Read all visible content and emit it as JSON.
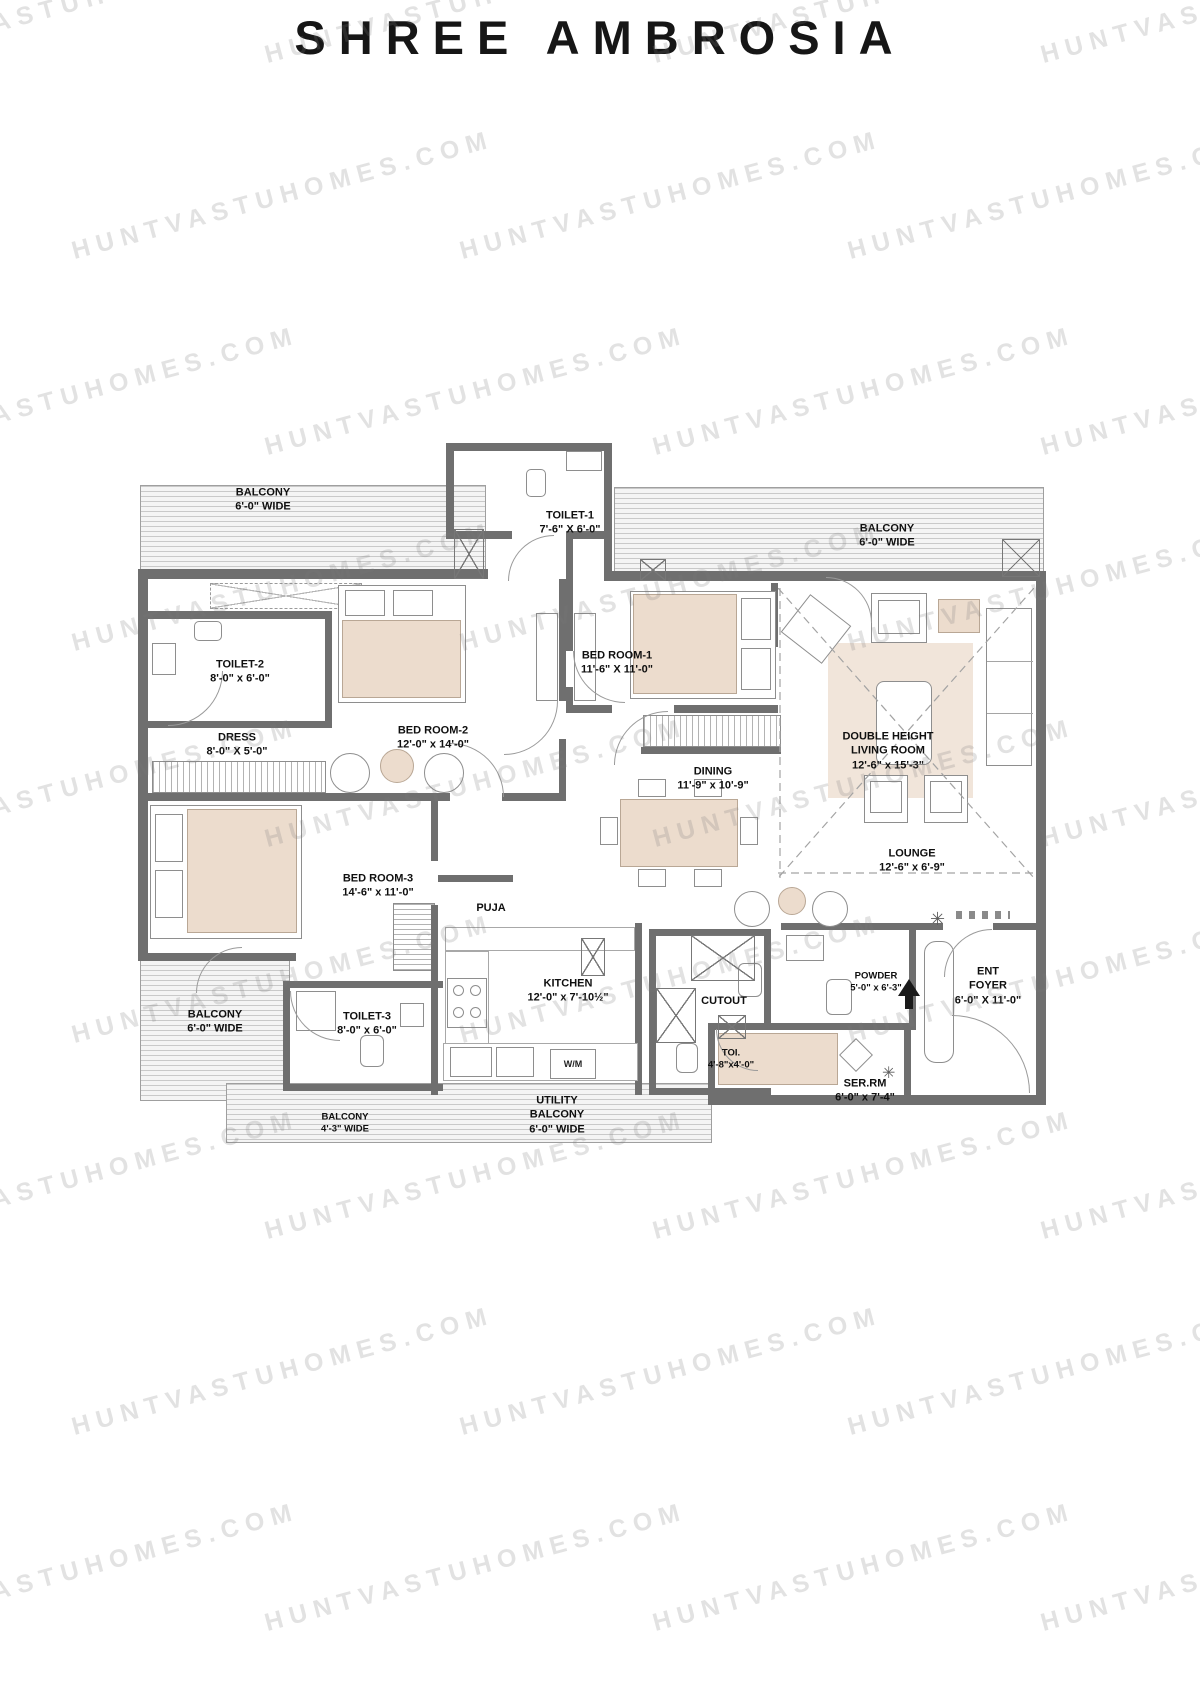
{
  "title": "SHREE AMBROSIA",
  "watermark": {
    "text": "HUNTVASTUHOMES.COM"
  },
  "plan": {
    "rooms": {
      "balcony_tl": {
        "name": "BALCONY",
        "dims": "6'-0\" WIDE"
      },
      "toilet_1": {
        "name": "TOILET-1",
        "dims": "7'-6\" X 6'-0\""
      },
      "balcony_tr": {
        "name": "BALCONY",
        "dims": "6'-0\" WIDE"
      },
      "toilet_2": {
        "name": "TOILET-2",
        "dims": "8'-0\" x 6'-0\""
      },
      "dress": {
        "name": "DRESS",
        "dims": "8'-0\" X 5'-0\""
      },
      "bed_room_2": {
        "name": "BED ROOM-2",
        "dims": "12'-0\" x 14'-0\""
      },
      "bed_room_1": {
        "name": "BED ROOM-1",
        "dims": "11'-6\" X 11'-0\""
      },
      "living": {
        "name": "DOUBLE HEIGHT",
        "name2": "LIVING ROOM",
        "dims": "12'-6\" x 15'-3\""
      },
      "dining": {
        "name": "DINING",
        "dims": "11'-9\" x 10'-9\""
      },
      "lounge": {
        "name": "LOUNGE",
        "dims": "12'-6\" x 6'-9\""
      },
      "bed_room_3": {
        "name": "BED ROOM-3",
        "dims": "14'-6\" x 11'-0\""
      },
      "puja": {
        "name": "PUJA"
      },
      "kitchen": {
        "name": "KITCHEN",
        "dims": "12'-0\" x 7'-10½\""
      },
      "cutout": {
        "name": "CUTOUT"
      },
      "powder": {
        "name": "POWDER",
        "dims": "5'-0\" x 6'-3\""
      },
      "ent_foyer": {
        "name": "ENT",
        "name2": "FOYER",
        "dims": "6'-0\" X 11'-0\""
      },
      "balcony_left": {
        "name": "BALCONY",
        "dims": "6'-0\" WIDE"
      },
      "toilet_3": {
        "name": "TOILET-3",
        "dims": "8'-0\" x 6'-0\""
      },
      "toi": {
        "name": "TOI.",
        "dims": "4'-8\"x4'-0\""
      },
      "ser_rm": {
        "name": "SER.RM",
        "dims": "6'-0\" x 7'-4\""
      },
      "balcony_bottom": {
        "name": "BALCONY",
        "dims": "4'-3\" WIDE"
      },
      "utility_balcony": {
        "name": "UTILITY",
        "name2": "BALCONY",
        "dims": "6'-0\" WIDE"
      },
      "wm": {
        "name": "W/M"
      }
    }
  }
}
